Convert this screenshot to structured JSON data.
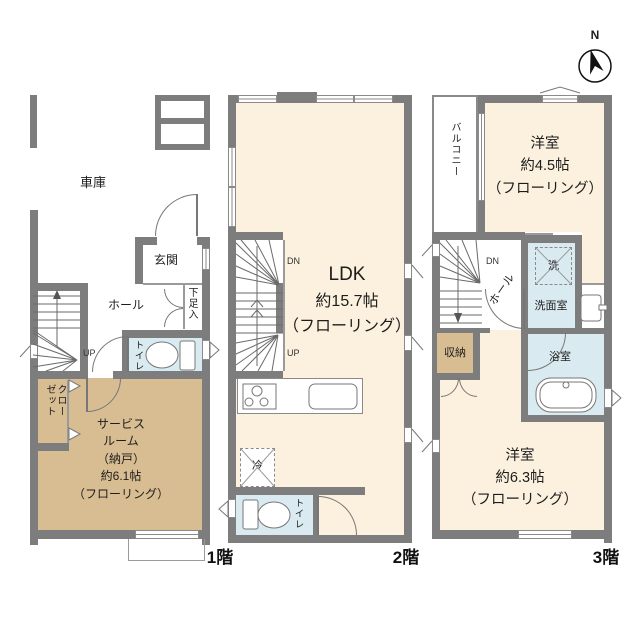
{
  "colors": {
    "wall": "#7d7d7d",
    "room_cream": "#FBF1DE",
    "room_tan": "#D8BD92",
    "room_blue": "#D9EBF1"
  },
  "compass": {
    "north_label": "N"
  },
  "floor1": {
    "floor_label": "1階",
    "garage": "車庫",
    "entrance": "玄関",
    "hall": "ホール",
    "shoe_cabinet": "下足入",
    "stairs_up": "UP",
    "toilet": "トイレ",
    "closet": "クローゼット",
    "service_room": "サービス\nルーム\n（納戸）\n約6.1帖\n（フローリング）"
  },
  "floor2": {
    "floor_label": "2階",
    "stairs_dn": "DN",
    "stairs_up": "UP",
    "ldk_name": "LDK",
    "ldk_details": "約15.7帖\n（フローリング）",
    "fridge": "冷",
    "toilet": "トイレ"
  },
  "floor3": {
    "floor_label": "3階",
    "balcony": "バルコニー",
    "bedroom_45": "洋室\n約4.5帖\n（フローリング）",
    "stairs_dn": "DN",
    "hall": "ホール",
    "washer": "洗",
    "washroom": "洗面室",
    "storage": "収納",
    "bathroom": "浴室",
    "bedroom_63": "洋室\n約6.3帖\n（フローリング）"
  }
}
